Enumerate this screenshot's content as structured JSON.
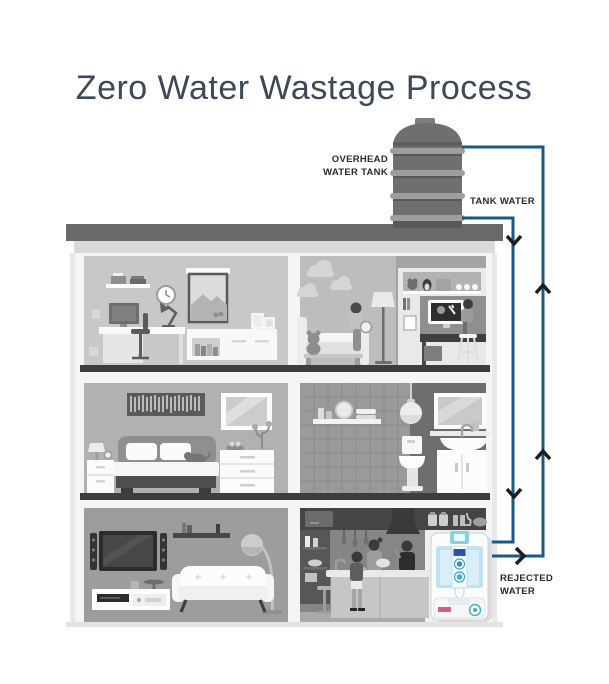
{
  "title": "Zero Water Wastage Process",
  "labels": {
    "overhead_tank_line1": "OVERHEAD",
    "overhead_tank_line2": "WATER TANK",
    "tank_water": "TANK WATER",
    "rejected_water_line1": "REJECTED",
    "rejected_water_line2": "WATER"
  },
  "colors": {
    "title": "#3d4956",
    "label": "#2a2a2a",
    "pipe": "#175a82",
    "arrow": "#1d1d1d",
    "purifier_accent": "#86d3de",
    "purifier_tank": "#bfe3f0",
    "background": "#ffffff"
  }
}
